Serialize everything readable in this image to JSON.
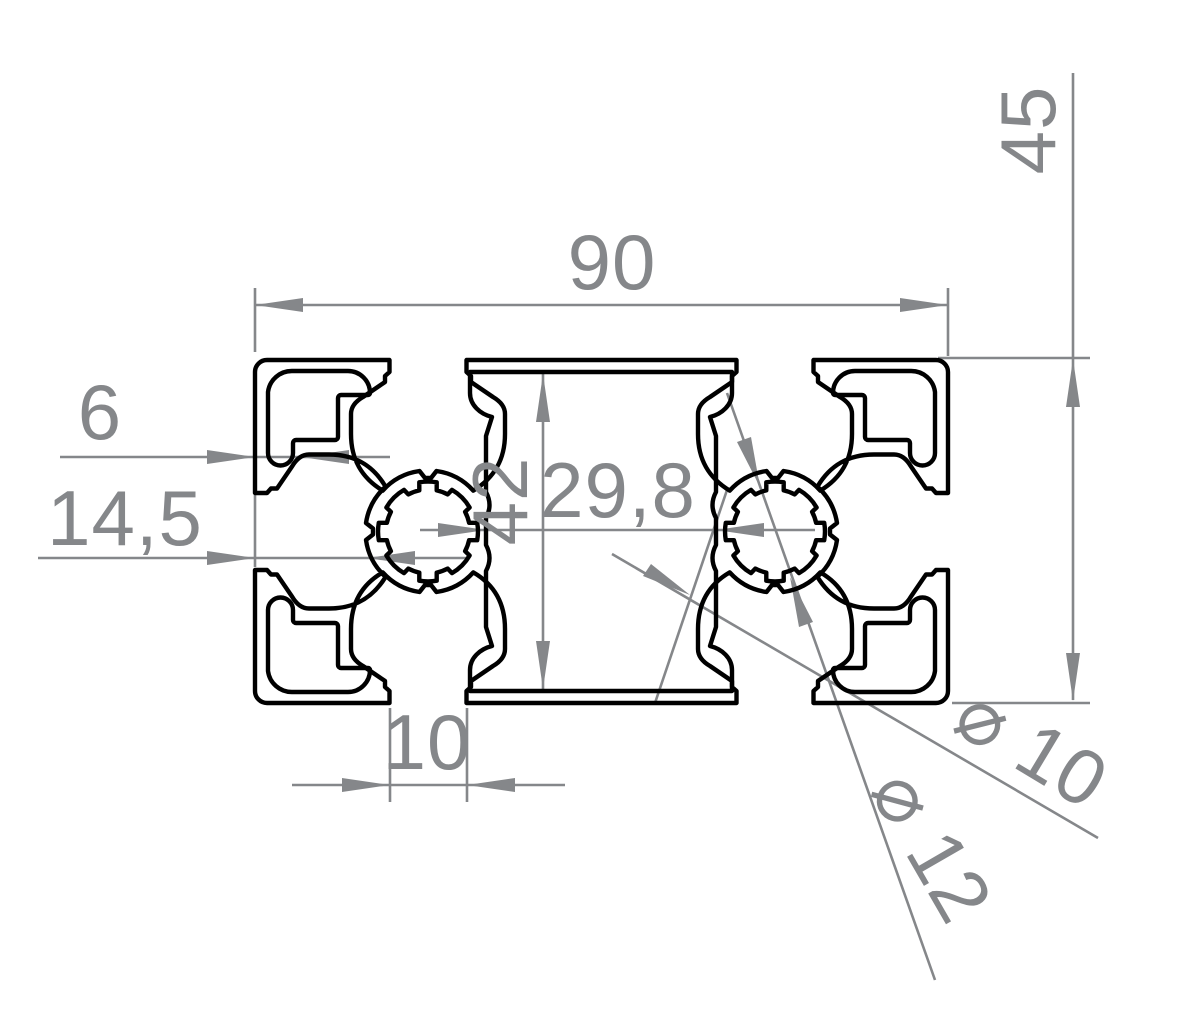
{
  "drawing": {
    "description": "Technical cross-section drawing of a 90x45 aluminium T-slot extrusion profile with dimension annotations",
    "colors": {
      "background": "#ffffff",
      "profile_line": "#000000",
      "dimension_line": "#85878a"
    },
    "labels": {
      "overall_width": "90",
      "overall_height": "45",
      "slot_lip_depth": "6",
      "slot_center_offset": "14,5",
      "cavity_height": "42",
      "cavity_width": "29,8",
      "slot_opening": "10",
      "core_bore": "⌀ 10",
      "core_serration": "⌀ 12"
    }
  }
}
